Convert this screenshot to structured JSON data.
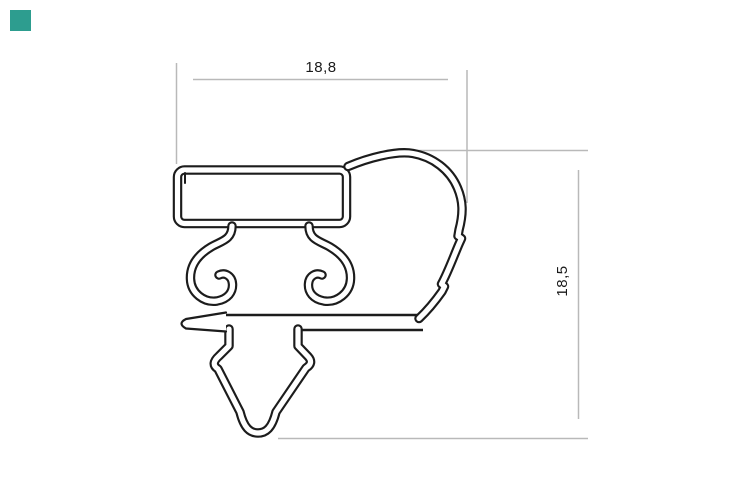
{
  "page": {
    "title": "gasket profile cross-section drawing",
    "background_color": "#ffffff"
  },
  "badge": {
    "color": "#2d9d8f"
  },
  "drawing": {
    "type": "technical-profile-cross-section",
    "stroke_color": "#1c1c1c",
    "dimension_line_color": "#b9b9b9",
    "dimensions": {
      "horizontal": {
        "label": "18,8"
      },
      "vertical": {
        "label": "18,5"
      }
    }
  }
}
